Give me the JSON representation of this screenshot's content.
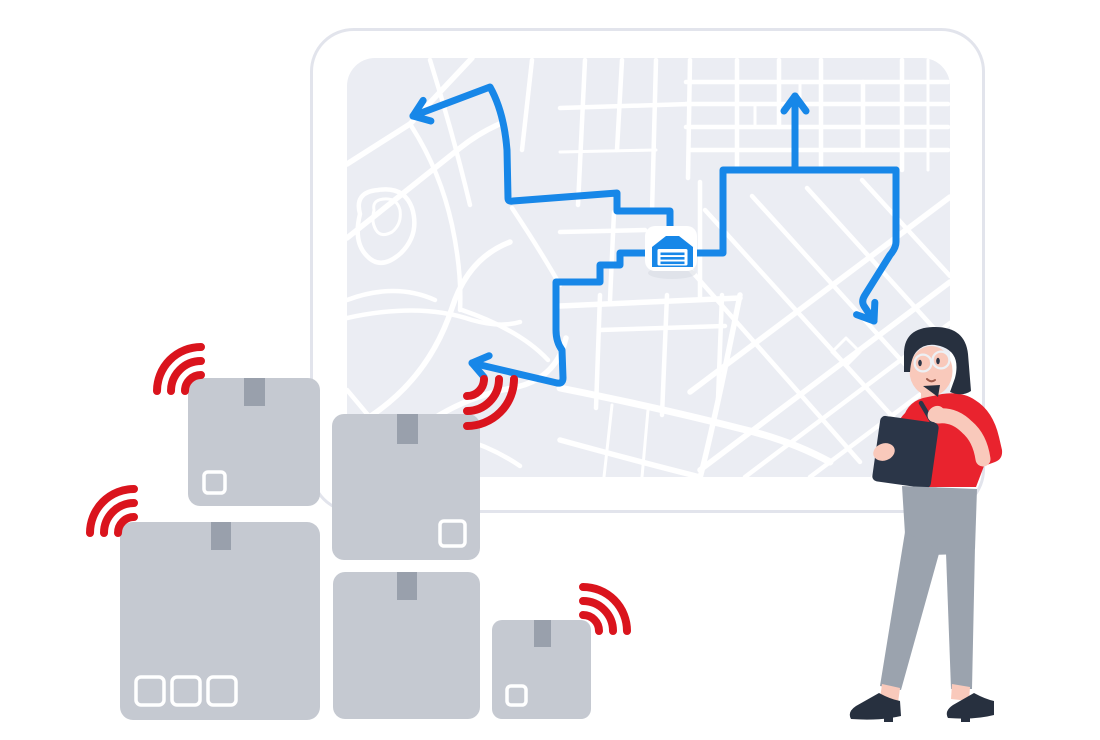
{
  "canvas": {
    "width": 1100,
    "height": 740
  },
  "colors": {
    "page_bg": "#ffffff",
    "board_fill": "#ffffff",
    "board_border": "#e2e4ec",
    "map_fill": "#ebedf3",
    "street": "#ffffff",
    "route_blue": "#1787e8",
    "signal_red": "#da141d",
    "box_gray": "#c5c9d1",
    "box_tape": "#99a0ac",
    "box_label": "#ffffff",
    "badge_fill": "#ffffff",
    "badge_shadow": "#d7dae1",
    "hair_dark": "#27303f",
    "skin": "#f9c9bb",
    "shirt_red": "#e9232e",
    "pants_gray": "#9ba3ae",
    "clipboard_navy": "#2b3648",
    "shoe_navy": "#27303f",
    "glasses": "#edf0f4",
    "face_detail": "#2b3547",
    "mouth": "#a05c4d"
  },
  "scene": {
    "map_board": {
      "route_arrow_count": 4,
      "marker_icon": "warehouse-icon"
    },
    "packages": {
      "box_count": 5,
      "wifi_signal_count": 4,
      "signal_icon": "wifi-arcs-icon"
    },
    "courier": {
      "accessories": [
        "glasses",
        "pen",
        "clipboard"
      ]
    }
  }
}
